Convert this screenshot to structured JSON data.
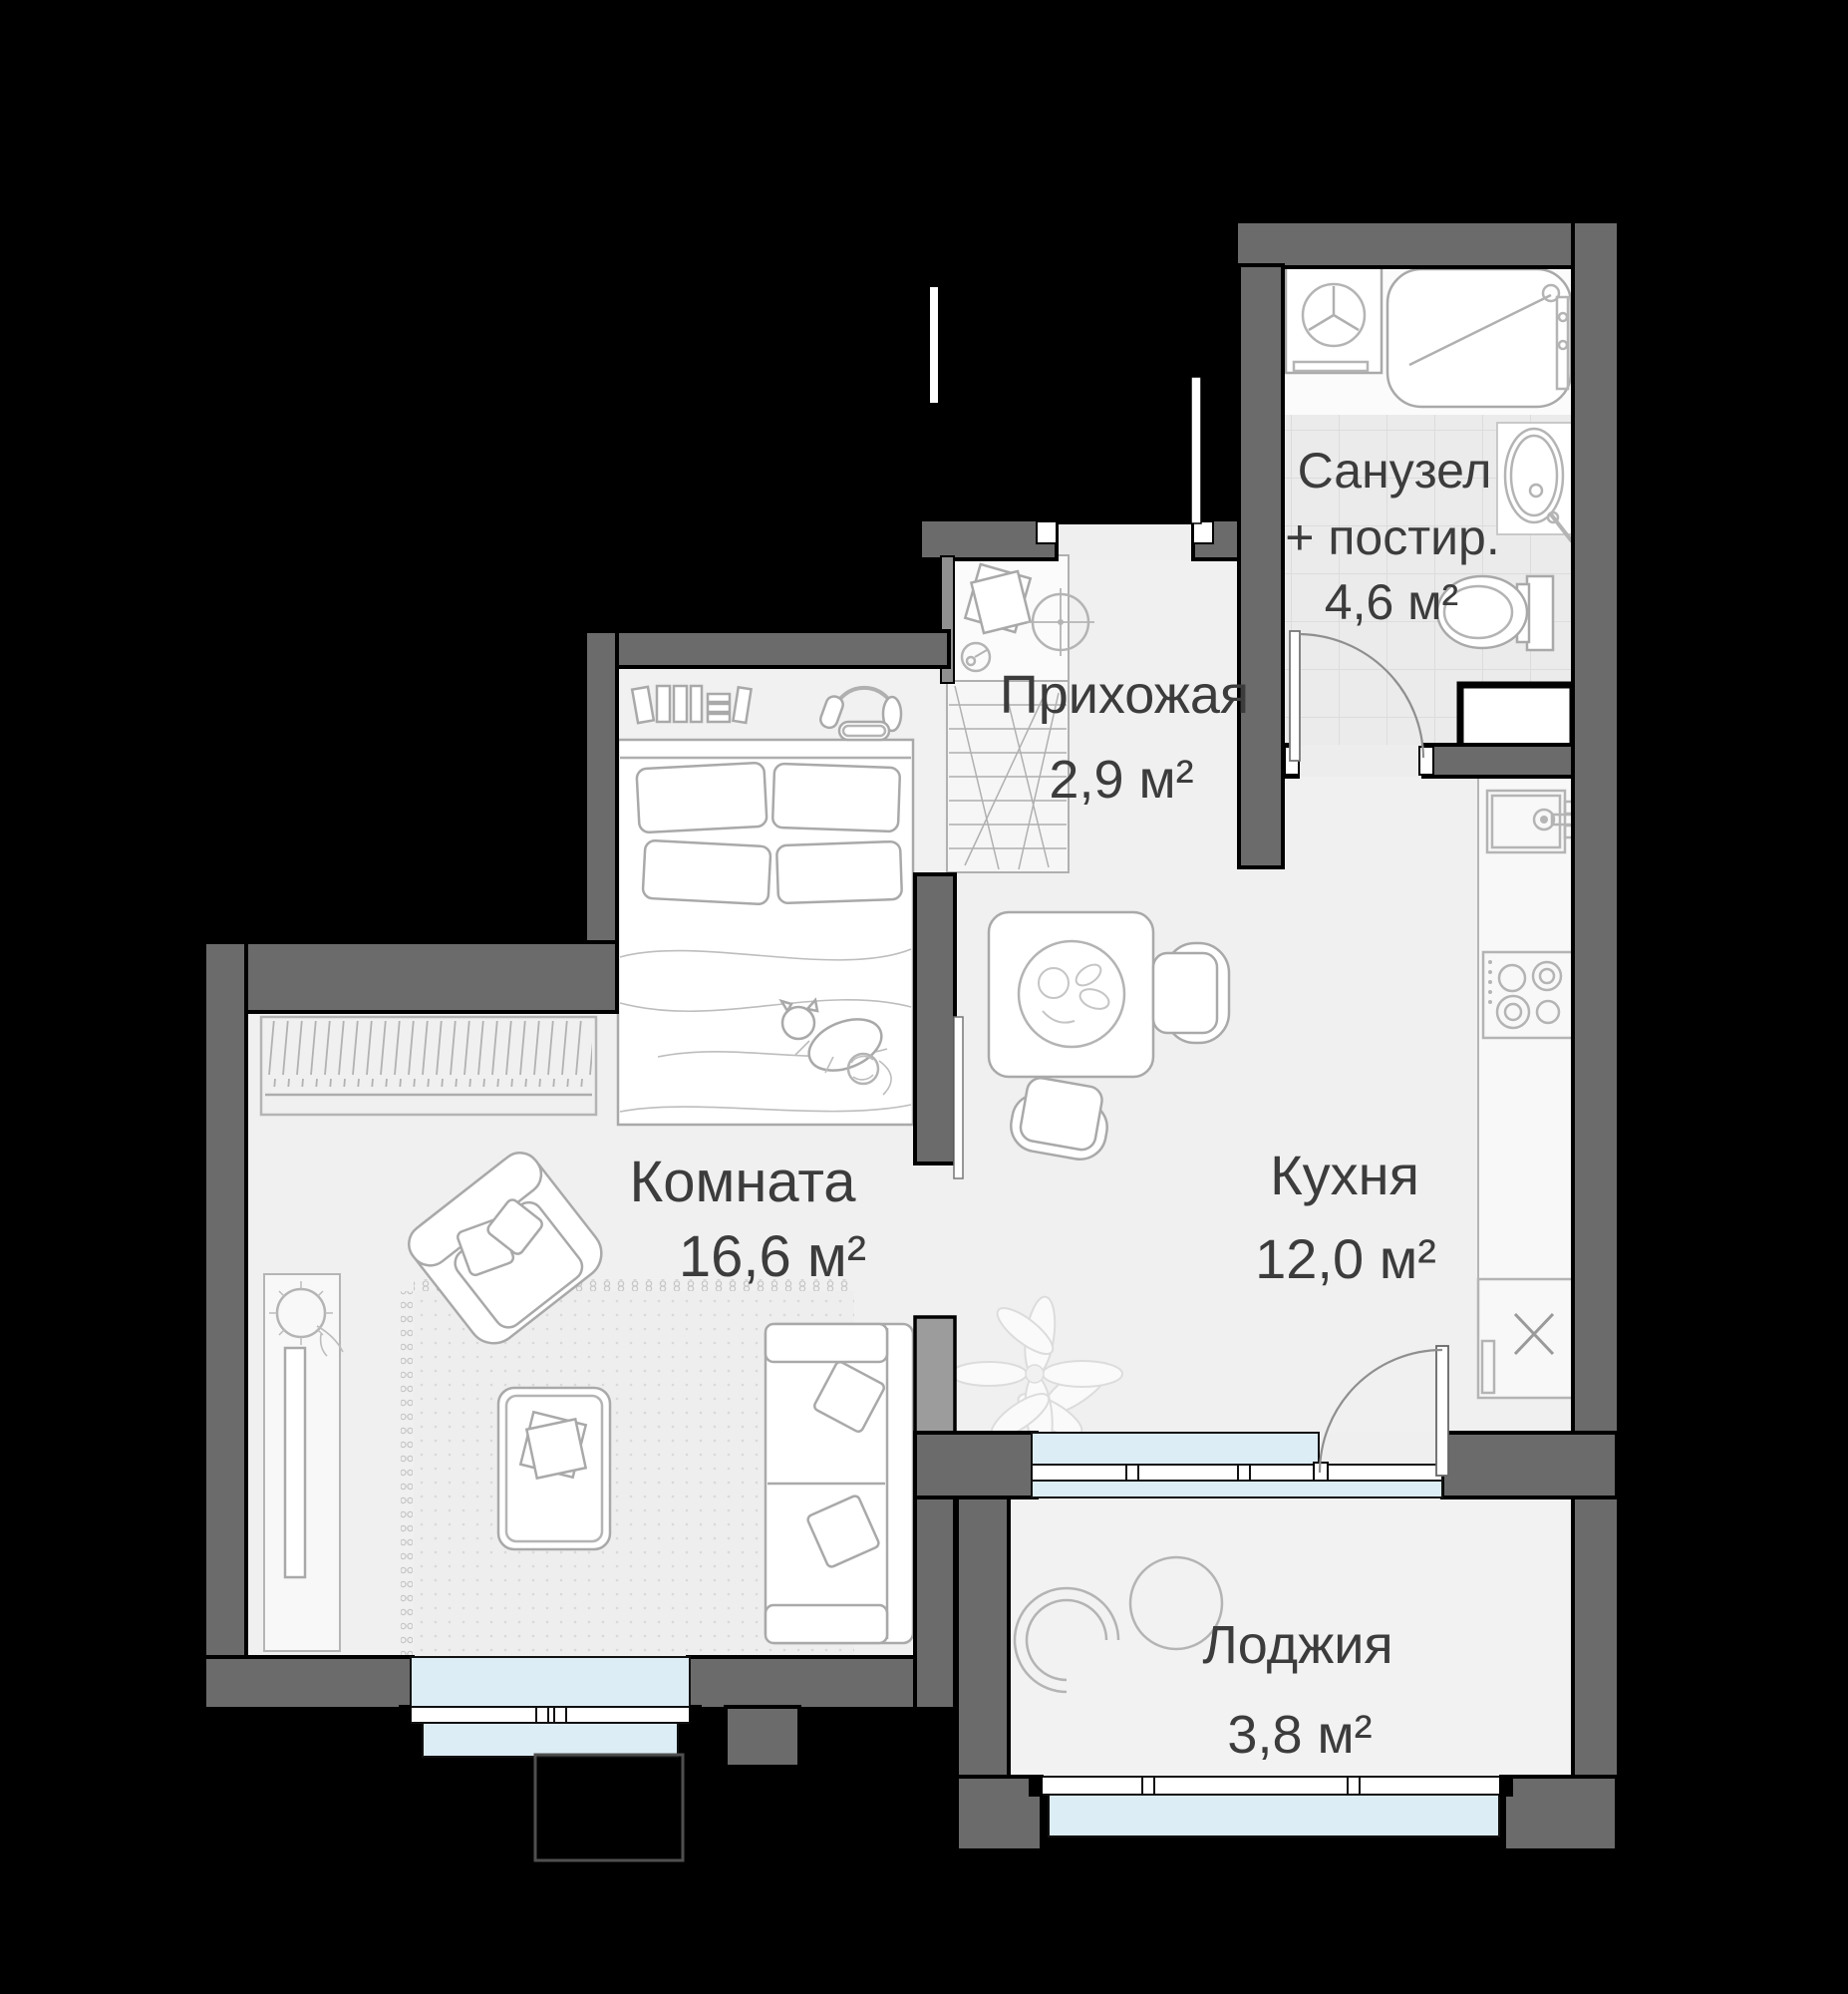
{
  "plan": {
    "type": "apartment-floor-plan",
    "rooms": [
      {
        "key": "hallway",
        "name": "Прихожая",
        "area": "2,9 м²"
      },
      {
        "key": "bathroom",
        "name": "Санузел",
        "name2": "+ постир.",
        "area": "4,6 м²"
      },
      {
        "key": "living",
        "name": "Комната",
        "area": "16,6 м²"
      },
      {
        "key": "kitchen",
        "name": "Кухня",
        "area": "12,0 м²"
      },
      {
        "key": "loggia",
        "name": "Лоджия",
        "area": "3,8 м²"
      }
    ],
    "colors": {
      "background": "#000000",
      "wall": "#6b6b6b",
      "wall_light": "#9c9c9c",
      "floor": "#f0f0f0",
      "tile": "#ebebeb",
      "window": "#ddedf6",
      "furniture_line": "#a9a9a9",
      "label_text": "#3c3c3c"
    },
    "symbols": {
      "bathroom": [
        "washing-machine-symbol",
        "bathtub-symbol",
        "washbasin-symbol",
        "toilet-symbol",
        "shaft-symbol"
      ],
      "hallway": [
        "closet-shelves-symbol",
        "ceiling-fan-symbol",
        "entry-door-symbol"
      ],
      "living": [
        "bed-symbol",
        "wardrobe-symbol",
        "armchair-symbol",
        "sofa-symbol",
        "coffee-table-symbol",
        "tv-console-symbol",
        "rug-symbol",
        "window-symbol"
      ],
      "kitchen": [
        "dining-table-symbol",
        "chair-symbol",
        "kitchen-counter-symbol",
        "kitchen-sink-symbol",
        "stove-symbol",
        "plant-symbol",
        "balcony-door-symbol"
      ],
      "loggia": [
        "lounge-chair-symbol",
        "window-symbol"
      ]
    }
  }
}
